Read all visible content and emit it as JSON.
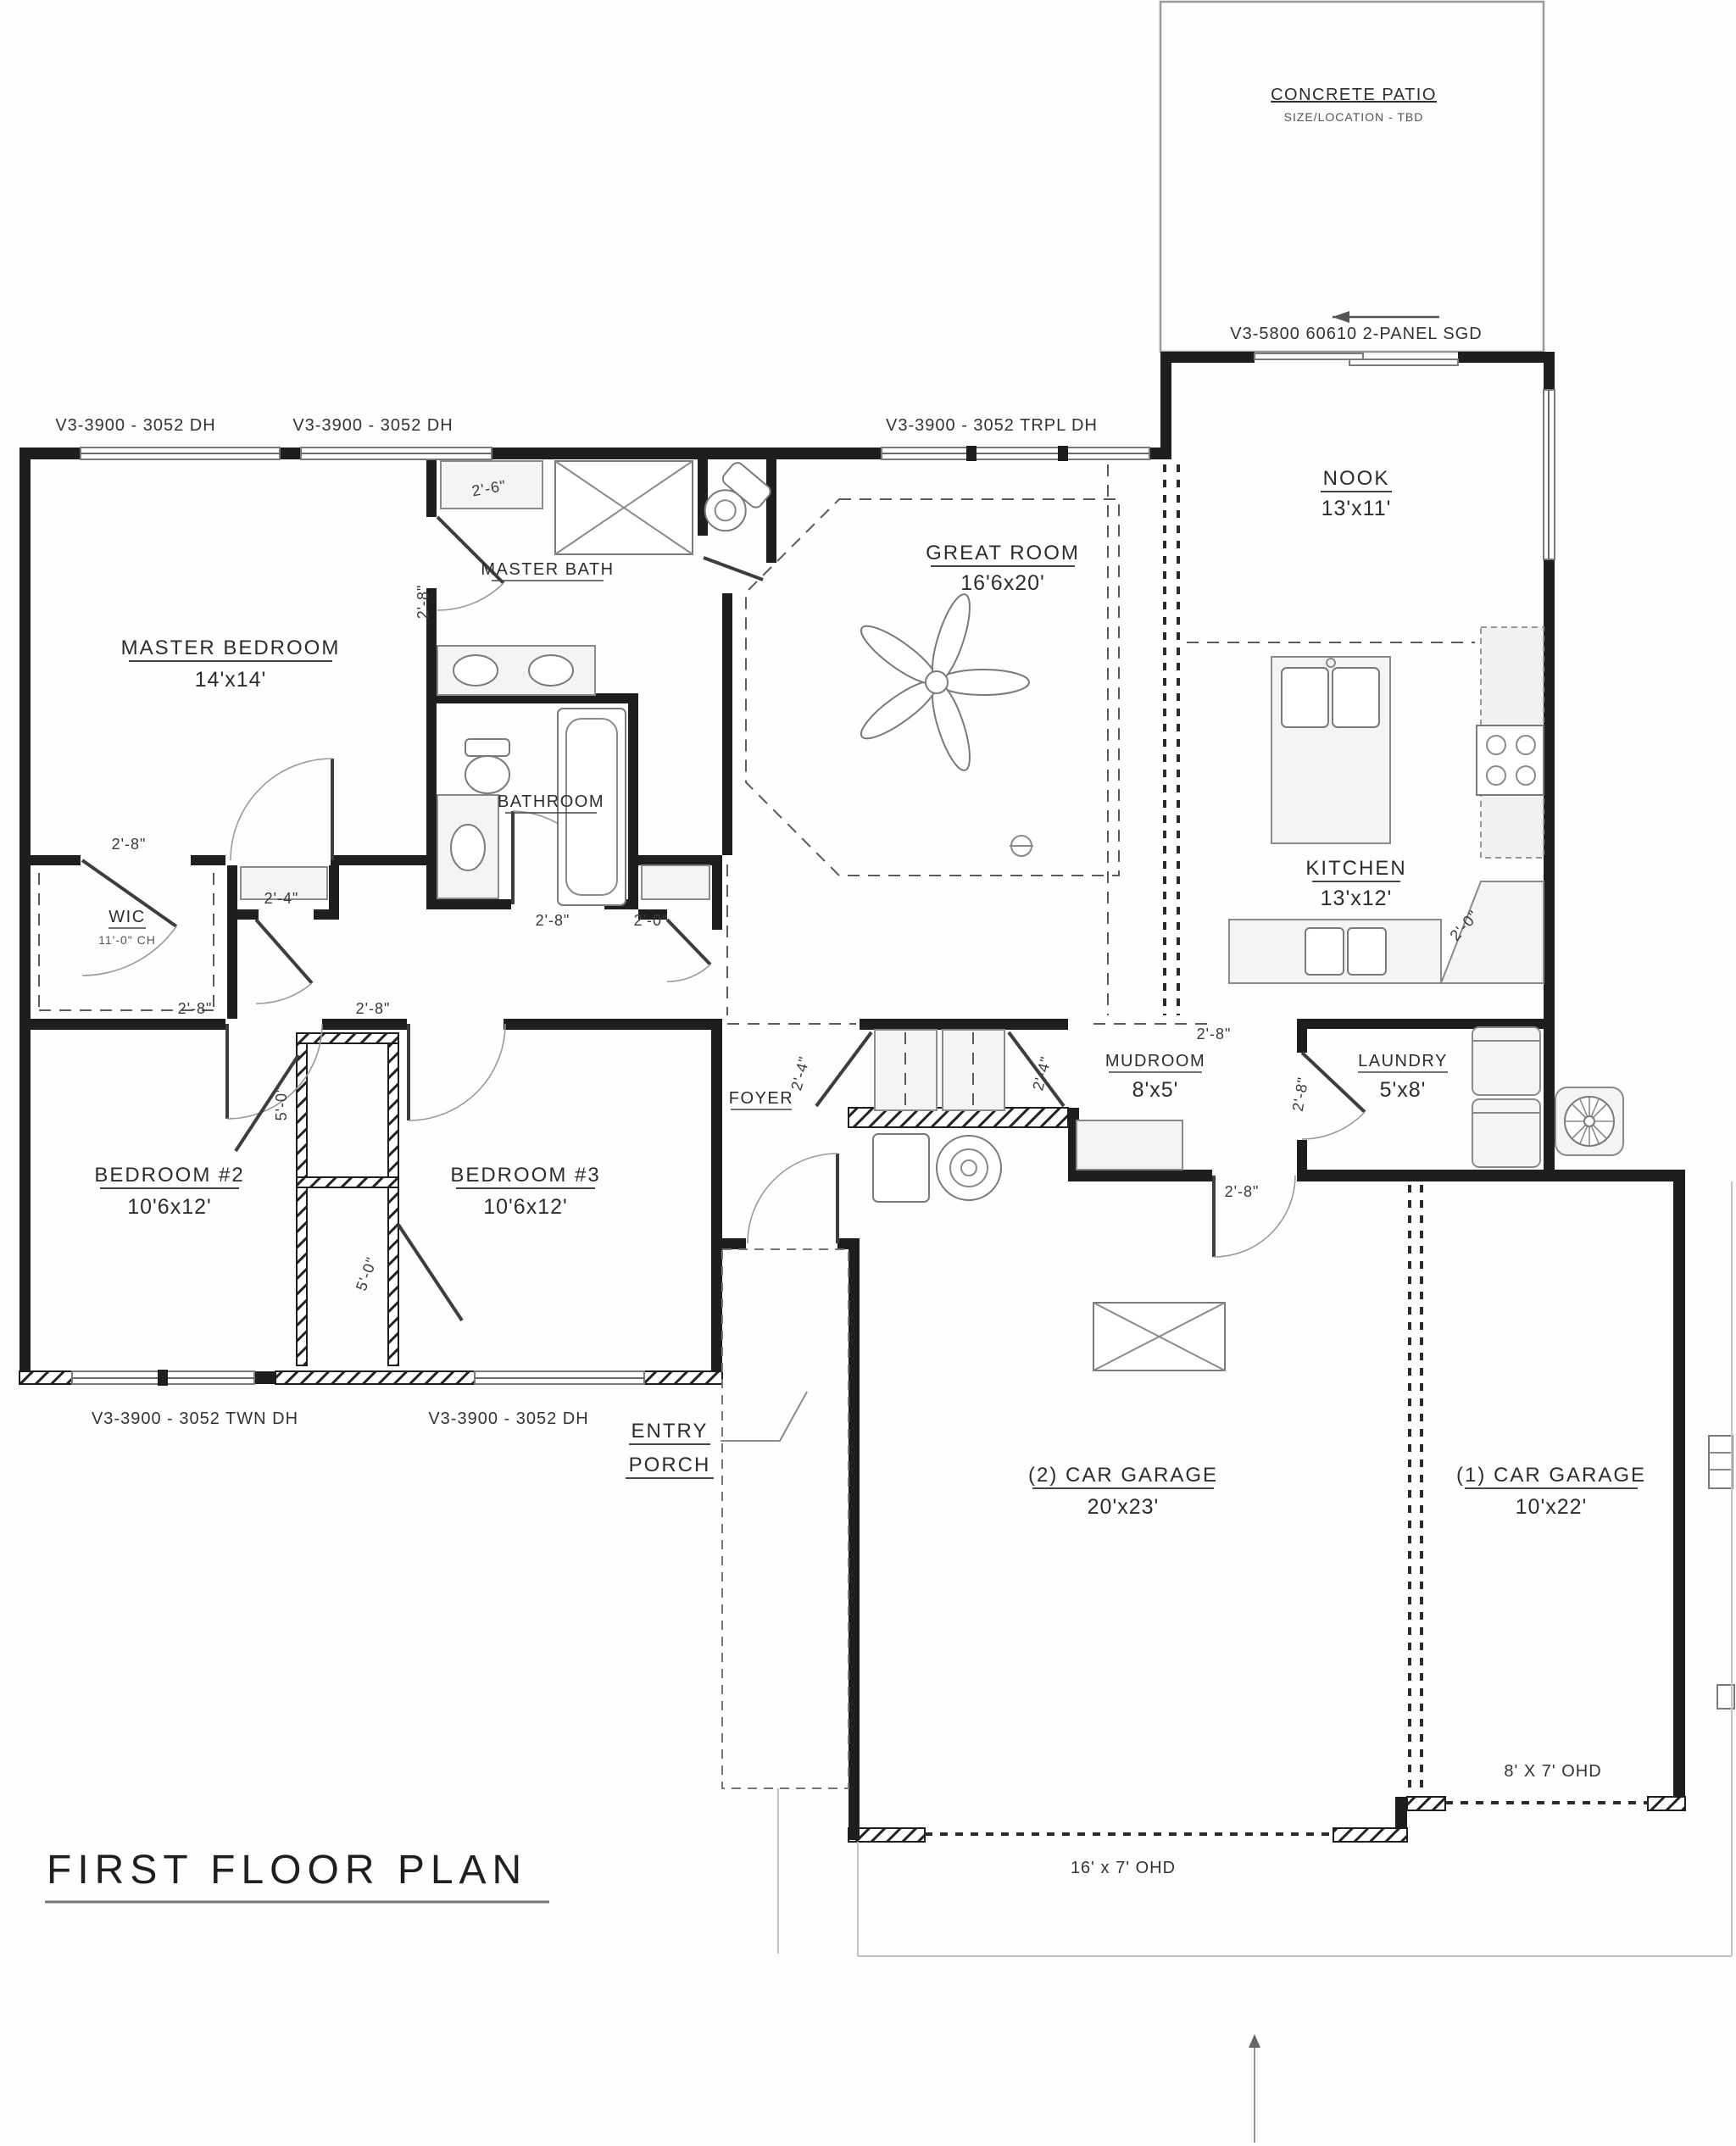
{
  "title": {
    "label": "FIRST FLOOR PLAN"
  },
  "rooms": {
    "patio": {
      "name": "CONCRETE PATIO",
      "sub": "SIZE/LOCATION - TBD"
    },
    "nook": {
      "name": "NOOK",
      "size": "13'x11'"
    },
    "great_room": {
      "name": "GREAT ROOM",
      "size": "16'6x20'"
    },
    "master_bedroom": {
      "name": "MASTER BEDROOM",
      "size": "14'x14'"
    },
    "master_bath": {
      "name": "MASTER BATH"
    },
    "bathroom": {
      "name": "BATHROOM"
    },
    "kitchen": {
      "name": "KITCHEN",
      "size": "13'x12'"
    },
    "wic": {
      "name": "WIC",
      "sub": "11'-0\" CH"
    },
    "foyer": {
      "name": "FOYER"
    },
    "mudroom": {
      "name": "MUDROOM",
      "size": "8'x5'"
    },
    "laundry": {
      "name": "LAUNDRY",
      "size": "5'x8'"
    },
    "bedroom2": {
      "name": "BEDROOM #2",
      "size": "10'6x12'"
    },
    "bedroom3": {
      "name": "BEDROOM #3",
      "size": "10'6x12'"
    },
    "entry_porch": {
      "line1": "ENTRY",
      "line2": "PORCH"
    },
    "garage2": {
      "name": "(2) CAR GARAGE",
      "size": "20'x23'"
    },
    "garage1": {
      "name": "(1) CAR GARAGE",
      "size": "10'x22'"
    }
  },
  "openings": {
    "sgd": "V3-5800 60610 2-PANEL SGD",
    "win_dh_a": "V3-3900 - 3052 DH",
    "win_dh_b": "V3-3900 - 3052 DH",
    "win_trpl": "V3-3900 - 3052 TRPL DH",
    "win_twn": "V3-3900 - 3052 TWN DH",
    "win_dh_c": "V3-3900 - 3052 DH",
    "ohd16": "16' x 7' OHD",
    "ohd8": "8' X 7' OHD"
  },
  "dims": {
    "d26": "2'-6\"",
    "d28": "2'-8\"",
    "d24": "2'-4\"",
    "d20": "2'-0\"",
    "d50": "5'-0\""
  },
  "colors": {
    "wall": "#1e1e1e",
    "line": "#8a8a8a",
    "fill": "#f4f4f4"
  }
}
